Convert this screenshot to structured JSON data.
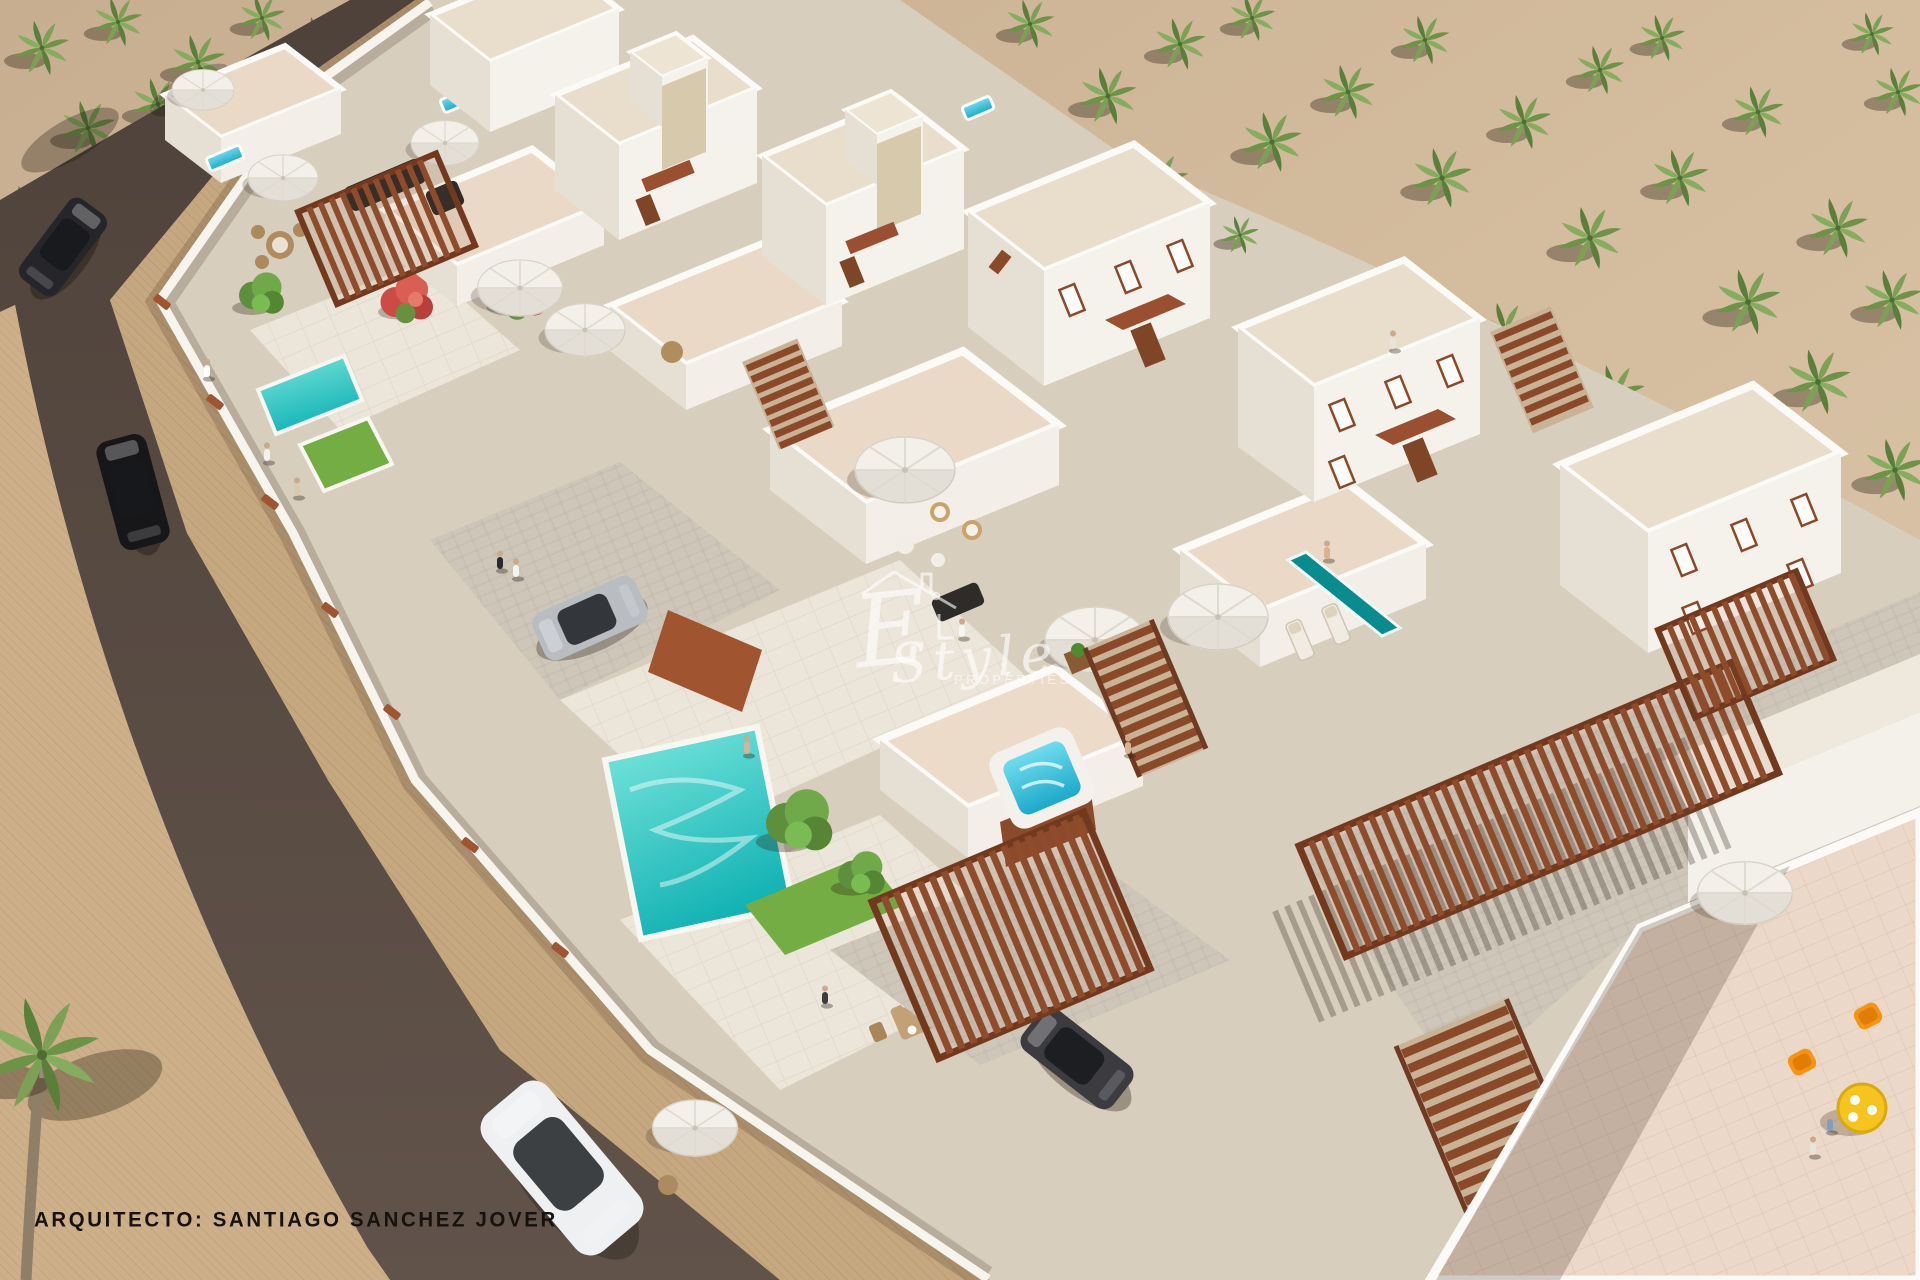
{
  "image": {
    "kind": "architectural 3d render",
    "subject": "aerial view of a whitewashed villa development with roof terraces, pools, timber pergolas, a palm grove and an asphalt road with cars"
  },
  "watermark": {
    "prefix": "E",
    "script": "Style",
    "sub": "PROPERTIES"
  },
  "caption": {
    "label": "ARQUITECTO: SANTIAGO SANCHEZ JOVER"
  },
  "palette": {
    "sand": "#d2ba9c",
    "road": "#574a41",
    "pavement": "#c4a67e",
    "villa_white": "#f5f2ec",
    "villa_shade": "#e6dfd3",
    "roof_terrace": "#e9d8c6",
    "terrace_pink": "#ecd9c9",
    "pergola_brown": "#8e4c2c",
    "awning_brown": "#9a5030",
    "pool_turquoise": "#2fc7c6",
    "lap_pool_teal": "#0a8c8f",
    "jacuzzi_blue": "#46cee4",
    "lawn_green": "#73ad43",
    "palm_green": "#7ca055",
    "cobble_gray": "#c5beb1",
    "chair_orange": "#f6930f",
    "table_yellow": "#f5c41f",
    "car_white": "#eef0f1",
    "car_silver": "#b9bdc2",
    "car_black": "#17171a"
  },
  "objects": [
    "palm-grove",
    "asphalt-road",
    "paved-promenade",
    "whitewashed-villas",
    "roof-terraces",
    "private-pools",
    "timber-pergolas",
    "rooftop-jacuzzi",
    "parked-cars",
    "outdoor-furniture"
  ]
}
